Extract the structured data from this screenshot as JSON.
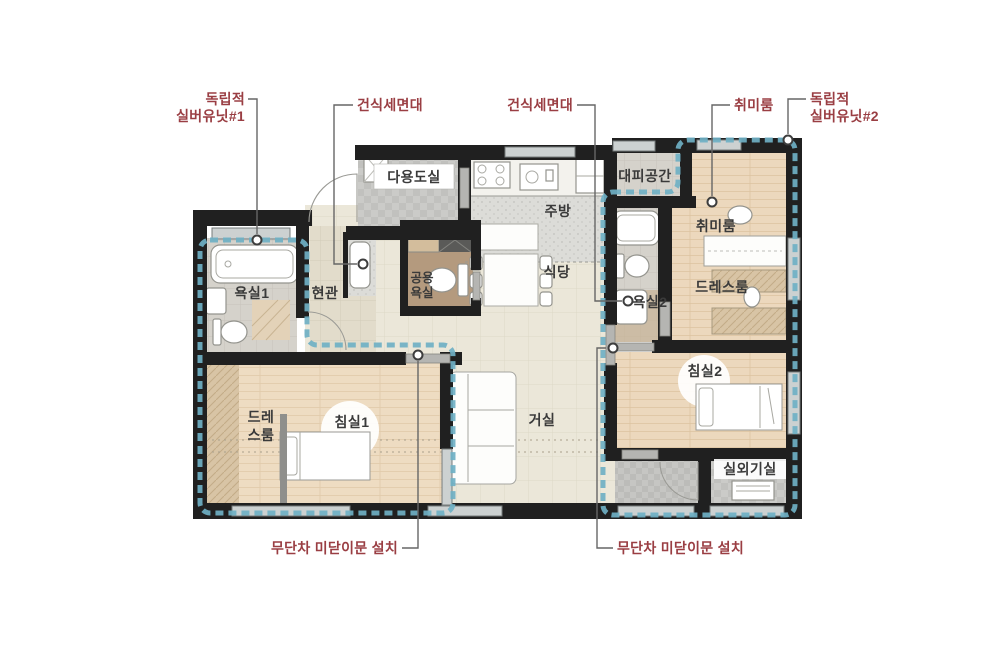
{
  "colors": {
    "callout_red": "#9a3e43",
    "boundary_teal": "#6fb0c4",
    "wall_black": "#202020"
  },
  "callouts": {
    "silver_unit_1_line1": "독립적",
    "silver_unit_1_line2": "실버유닛#1",
    "dry_washstand_left": "건식세면대",
    "dry_washstand_right": "건식세면대",
    "hobby_room": "취미룸",
    "silver_unit_2_line1": "독립적",
    "silver_unit_2_line2": "실버유닛#2",
    "stepless_sliding_door_left": "무단차 미닫이문 설치",
    "stepless_sliding_door_right": "무단차 미닫이문 설치"
  },
  "rooms": {
    "utility": "다용도실",
    "kitchen": "주방",
    "refuge": "대피공간",
    "hobby": "취미룸",
    "entrance": "현관",
    "bath1": "욕실1",
    "shared_bath_line1": "공용",
    "shared_bath_line2": "욕실",
    "dining": "식당",
    "bath2": "욕실2",
    "dress2": "드레스룸",
    "dress1_line1": "드레",
    "dress1_line2": "스룸",
    "bedroom1": "침실1",
    "living": "거실",
    "bedroom2": "침실2",
    "outdoor_unit": "실외기실"
  }
}
